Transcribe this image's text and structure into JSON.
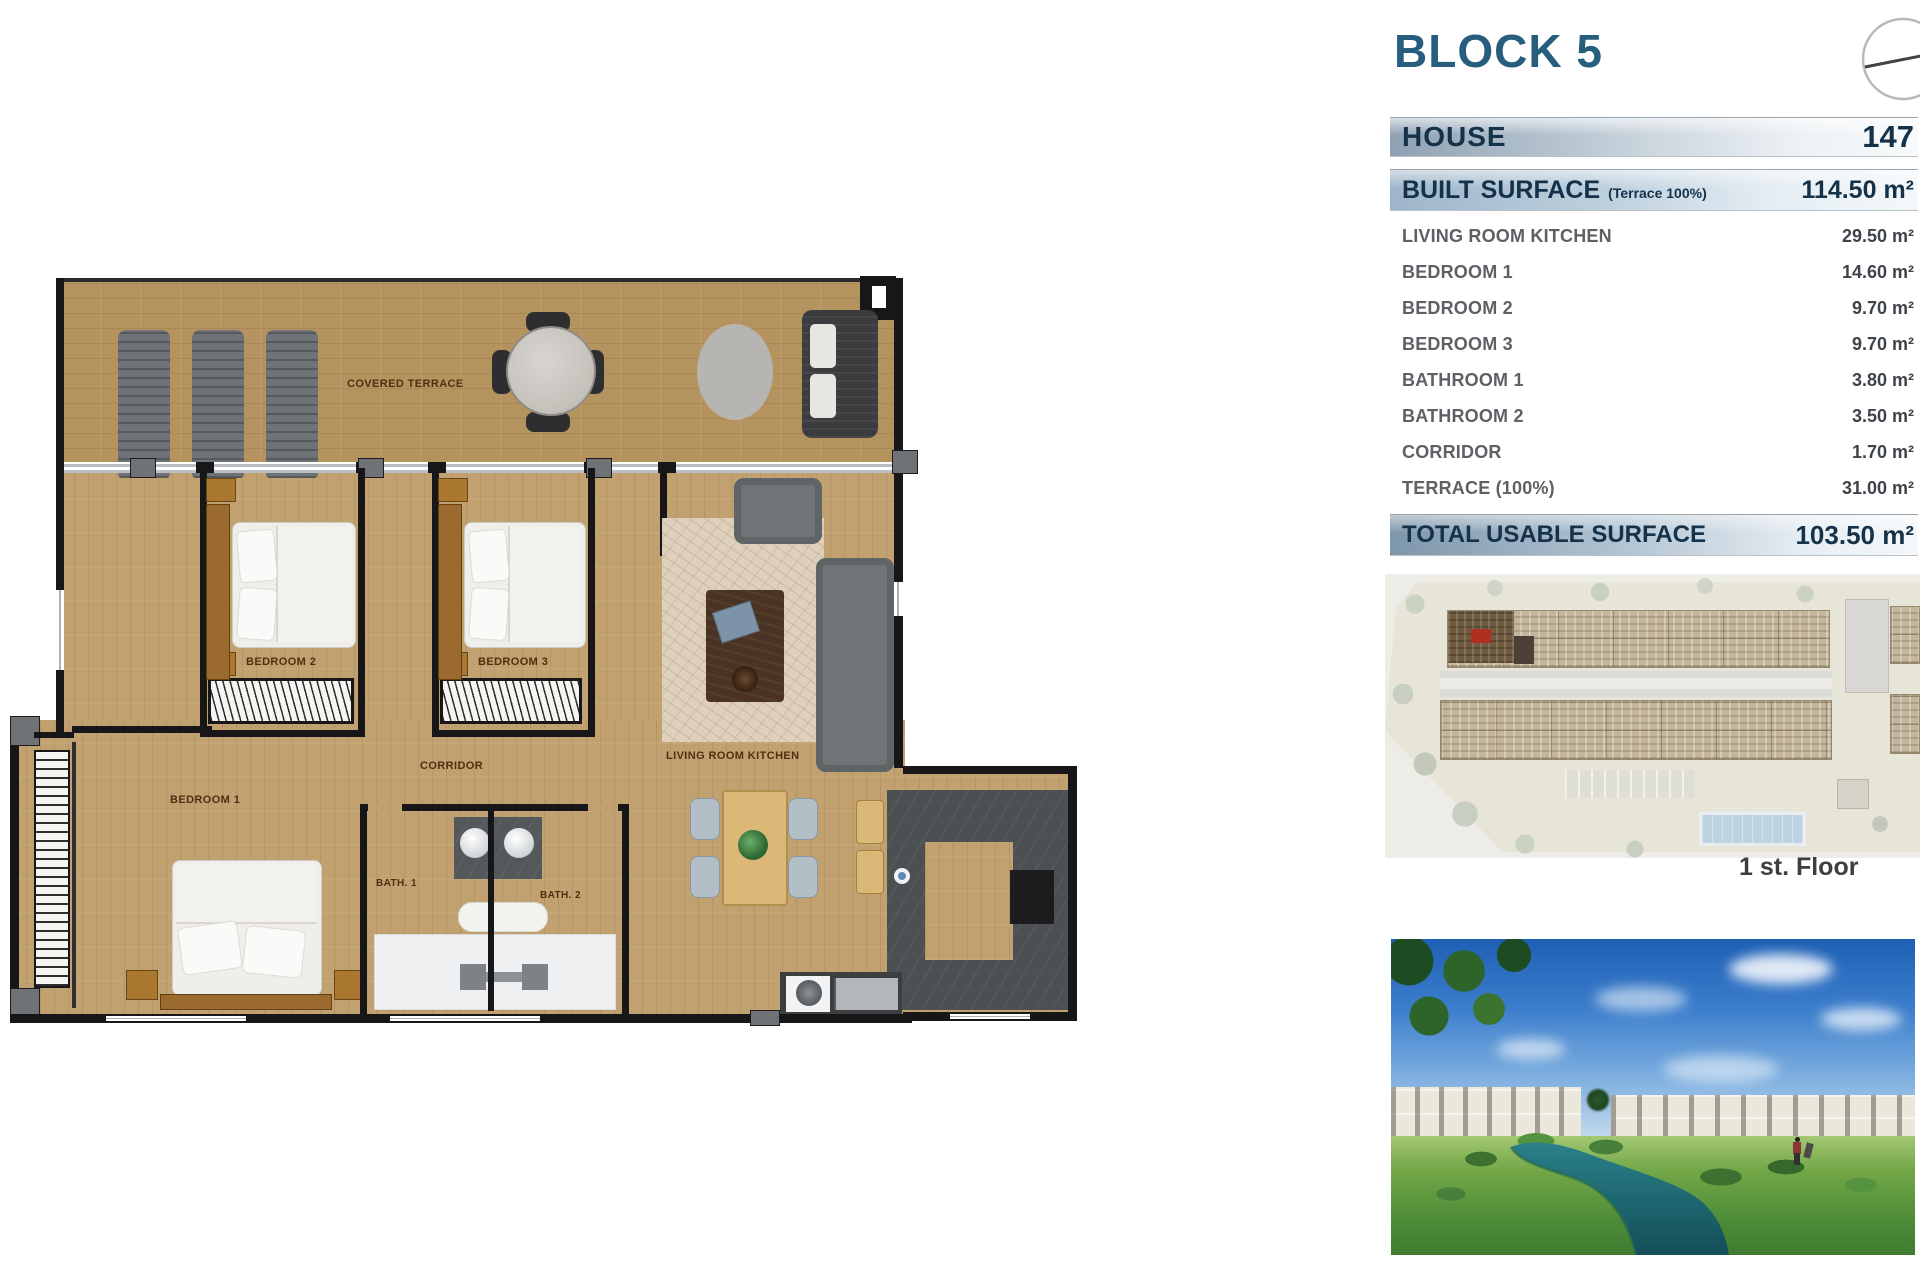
{
  "header": {
    "block_title": "BLOCK 5",
    "house_label": "HOUSE",
    "house_number": "147"
  },
  "surface_table": {
    "built_surface": {
      "label": "BUILT SURFACE",
      "note": "(Terrace 100%)",
      "value": "114.50 m²"
    },
    "rows": [
      {
        "label": "LIVING ROOM KITCHEN",
        "value": "29.50 m²"
      },
      {
        "label": "BEDROOM 1",
        "value": "14.60 m²"
      },
      {
        "label": "BEDROOM 2",
        "value": "9.70 m²"
      },
      {
        "label": "BEDROOM 3",
        "value": "9.70 m²"
      },
      {
        "label": "BATHROOM 1",
        "value": "3.80 m²"
      },
      {
        "label": "BATHROOM 2",
        "value": "3.50 m²"
      },
      {
        "label": "CORRIDOR",
        "value": "1.70 m²"
      },
      {
        "label": "TERRACE (100%)",
        "value": "31.00 m²"
      }
    ],
    "total": {
      "label": "TOTAL USABLE SURFACE",
      "value": "103.50 m²"
    }
  },
  "site_plan": {
    "floor_label": "1 st. Floor"
  },
  "floor_plan": {
    "labels": {
      "covered_terrace": "COVERED TERRACE",
      "bedroom1": "BEDROOM 1",
      "bedroom2": "BEDROOM 2",
      "bedroom3": "BEDROOM 3",
      "corridor": "CORRIDOR",
      "bath1": "BATH. 1",
      "bath2": "BATH. 2",
      "living_room_kitchen": "LIVING ROOM KITCHEN"
    }
  },
  "colors": {
    "title_blue": "#275d7d",
    "accent_navy": "#14324a",
    "wood_floor": "#c2a170",
    "terrace_wood": "#b5935f",
    "wall_black": "#17171a",
    "highlight_red": "#b03020",
    "water_teal": "#1f6e78"
  }
}
